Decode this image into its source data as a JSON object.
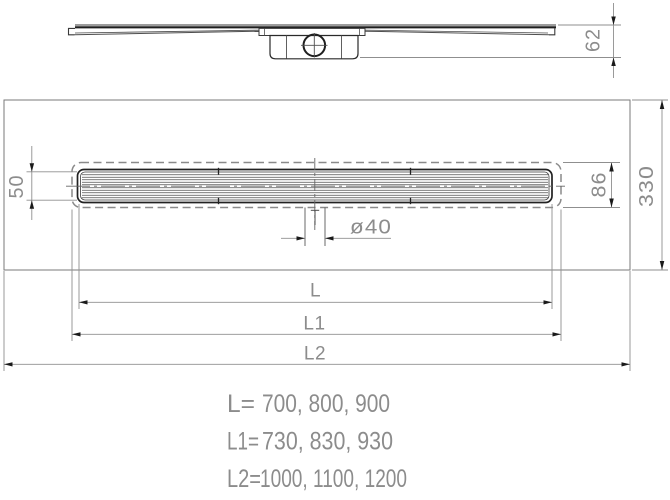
{
  "dimensions": {
    "side_height": "62",
    "channel_width": "50",
    "flange_width": "86",
    "membrane_width": "330",
    "outlet_diameter": "ø40",
    "length_label": "L",
    "length1_label": "L1",
    "length2_label": "L2"
  },
  "size_table": [
    {
      "label": "L=",
      "values": "700, 800, 900"
    },
    {
      "label": "L1=",
      "values": "730, 830, 930"
    },
    {
      "label": "L2=",
      "values": "1000, 1100, 1200"
    }
  ],
  "colors": {
    "background": "#ffffff",
    "object_line": "#2a2a2a",
    "secondary_line": "#4f4f4f",
    "dashed_hidden_line": "#8a8a8a",
    "dimension_line": "#8f8f8f",
    "arrow": "#1a1a1a",
    "text": "#8c8c8c"
  }
}
